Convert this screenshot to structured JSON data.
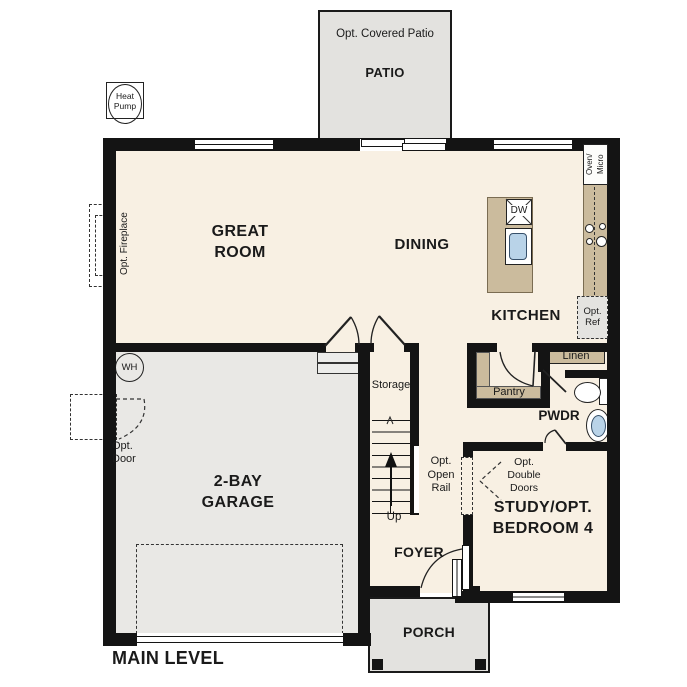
{
  "title": "MAIN LEVEL",
  "colors": {
    "floor": "#f8f0e3",
    "garage": "#e9e8e5",
    "outdoor": "#e3e2df",
    "cabinet": "#cbbb9d",
    "wall": "#141414",
    "fixture_blue": "#b9d3e8"
  },
  "patio": {
    "opt_label": "Opt. Covered Patio",
    "label": "PATIO"
  },
  "porch": {
    "label": "PORCH"
  },
  "rooms": {
    "great_room": {
      "line1": "GREAT",
      "line2": "ROOM"
    },
    "dining": {
      "label": "DINING"
    },
    "kitchen": {
      "label": "KITCHEN"
    },
    "garage": {
      "line1": "2-BAY",
      "line2": "GARAGE"
    },
    "study": {
      "line1": "STUDY/OPT.",
      "line2": "BEDROOM 4"
    },
    "foyer": {
      "label": "FOYER"
    },
    "powder": {
      "label": "PWDR"
    },
    "pantry": {
      "label": "Pantry"
    },
    "linen": {
      "label": "Linen"
    },
    "storage": {
      "label": "Storage"
    }
  },
  "stairs": {
    "up": "Up",
    "opt_rail": [
      "Opt.",
      "Open",
      "Rail"
    ]
  },
  "options": {
    "fireplace": "Opt. Fireplace",
    "door": [
      "Opt.",
      "Door"
    ],
    "double_doors": [
      "Opt.",
      "Double",
      "Doors"
    ],
    "ref": [
      "Opt.",
      "Ref"
    ]
  },
  "fixtures": {
    "heat_pump": [
      "Heat",
      "Pump"
    ],
    "water_heater": "WH",
    "dishwasher": "DW",
    "oven_micro_line1": "Oven/",
    "oven_micro_line2": "Micro"
  }
}
